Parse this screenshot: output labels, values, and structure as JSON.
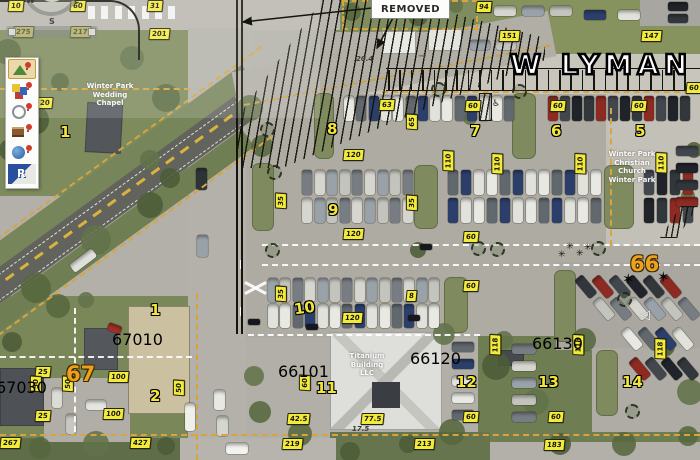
{
  "overlay": {
    "street_name": "W LYMAN",
    "removed_note": "REMOVED",
    "compass": {
      "w": "W",
      "e": "E",
      "s": "S"
    },
    "colors": {
      "label_yellow": "#f3eb3c",
      "lot_number_yellow": "#f2e637",
      "zone_orange": "#efa11c",
      "parcel_red": "#cf3b31",
      "parcel_tan_dash": "#d7a43e",
      "hatch_black": "#15150d"
    },
    "notes": [
      {
        "t": "20.4",
        "x": 356,
        "y": 55
      },
      {
        "t": "17.5",
        "x": 352,
        "y": 425
      }
    ],
    "labels": [
      {
        "t": "10",
        "x": 8,
        "y": 0
      },
      {
        "t": "60",
        "x": 70,
        "y": 0
      },
      {
        "t": "275",
        "x": 13,
        "y": 26
      },
      {
        "t": "217",
        "x": 70,
        "y": 26
      },
      {
        "t": "31",
        "x": 147,
        "y": 0
      },
      {
        "t": "201",
        "x": 149,
        "y": 28
      },
      {
        "t": "94",
        "x": 476,
        "y": 1
      },
      {
        "t": "151",
        "x": 499,
        "y": 30
      },
      {
        "t": "147",
        "x": 641,
        "y": 30
      },
      {
        "t": "60",
        "x": 686,
        "y": 82
      },
      {
        "t": "63",
        "x": 379,
        "y": 99
      },
      {
        "t": "60",
        "x": 465,
        "y": 100
      },
      {
        "t": "60",
        "x": 550,
        "y": 100
      },
      {
        "t": "60",
        "x": 631,
        "y": 100
      },
      {
        "t": "20",
        "x": 37,
        "y": 97
      },
      {
        "t": "120",
        "x": 343,
        "y": 149
      },
      {
        "t": "120",
        "x": 343,
        "y": 228
      },
      {
        "t": "120",
        "x": 342,
        "y": 312
      },
      {
        "t": "60",
        "x": 463,
        "y": 231
      },
      {
        "t": "60",
        "x": 463,
        "y": 280
      },
      {
        "t": "8",
        "x": 406,
        "y": 290
      },
      {
        "t": "60",
        "x": 463,
        "y": 411
      },
      {
        "t": "60",
        "x": 548,
        "y": 411
      },
      {
        "t": "25",
        "x": 35,
        "y": 366
      },
      {
        "t": "25",
        "x": 35,
        "y": 410
      },
      {
        "t": "100",
        "x": 108,
        "y": 371
      },
      {
        "t": "100",
        "x": 103,
        "y": 408
      },
      {
        "t": "42.5",
        "x": 287,
        "y": 413
      },
      {
        "t": "77.5",
        "x": 361,
        "y": 413
      },
      {
        "t": "219",
        "x": 282,
        "y": 438
      },
      {
        "t": "213",
        "x": 414,
        "y": 438
      },
      {
        "t": "183",
        "x": 544,
        "y": 439
      },
      {
        "t": "267",
        "x": 0,
        "y": 437
      },
      {
        "t": "427",
        "x": 130,
        "y": 437
      },
      {
        "t": "110",
        "x": 438,
        "y": 155,
        "k": "v"
      },
      {
        "t": "110",
        "x": 487,
        "y": 158,
        "k": "v"
      },
      {
        "t": "110",
        "x": 570,
        "y": 158,
        "k": "v"
      },
      {
        "t": "110",
        "x": 651,
        "y": 157,
        "k": "v"
      },
      {
        "t": "118",
        "x": 485,
        "y": 339,
        "k": "v"
      },
      {
        "t": "118",
        "x": 568,
        "y": 339,
        "k": "v"
      },
      {
        "t": "118",
        "x": 650,
        "y": 343,
        "k": "v"
      },
      {
        "t": "65",
        "x": 404,
        "y": 116,
        "k": "v"
      },
      {
        "t": "35",
        "x": 273,
        "y": 195,
        "k": "v"
      },
      {
        "t": "35",
        "x": 404,
        "y": 197,
        "k": "v"
      },
      {
        "t": "35",
        "x": 273,
        "y": 288,
        "k": "v"
      },
      {
        "t": "50",
        "x": 28,
        "y": 378,
        "k": "v"
      },
      {
        "t": "50",
        "x": 60,
        "y": 378,
        "k": "v"
      },
      {
        "t": "50",
        "x": 171,
        "y": 382,
        "k": "v"
      },
      {
        "t": "60",
        "x": 297,
        "y": 377,
        "k": "v"
      },
      {
        "t": "8",
        "x": 327,
        "y": 122,
        "k": "n"
      },
      {
        "t": "7",
        "x": 470,
        "y": 124,
        "k": "n"
      },
      {
        "t": "6",
        "x": 551,
        "y": 124,
        "k": "n"
      },
      {
        "t": "5",
        "x": 635,
        "y": 124,
        "k": "n"
      },
      {
        "t": "9",
        "x": 328,
        "y": 203,
        "k": "n"
      },
      {
        "t": "10",
        "x": 294,
        "y": 301,
        "k": "n",
        "r": -8
      },
      {
        "t": "11",
        "x": 316,
        "y": 381,
        "k": "n"
      },
      {
        "t": "12",
        "x": 456,
        "y": 375,
        "k": "n"
      },
      {
        "t": "13",
        "x": 538,
        "y": 375,
        "k": "n"
      },
      {
        "t": "14",
        "x": 622,
        "y": 375,
        "k": "n"
      },
      {
        "t": "1",
        "x": 60,
        "y": 125,
        "k": "n"
      },
      {
        "t": "1",
        "x": 150,
        "y": 303,
        "k": "n"
      },
      {
        "t": "2",
        "x": 150,
        "y": 389,
        "k": "n"
      },
      {
        "t": "67",
        "x": 66,
        "y": 364,
        "k": "z"
      },
      {
        "t": "66",
        "x": 630,
        "y": 254,
        "k": "z"
      },
      {
        "t": "67030",
        "x": -4,
        "y": 378,
        "k": "r"
      },
      {
        "t": "67010",
        "x": 112,
        "y": 330,
        "k": "r"
      },
      {
        "t": "66101",
        "x": 278,
        "y": 362,
        "k": "r"
      },
      {
        "t": "66120",
        "x": 410,
        "y": 349,
        "k": "r"
      },
      {
        "t": "66130",
        "x": 532,
        "y": 334,
        "k": "r"
      }
    ],
    "place_texts": [
      {
        "x": 80,
        "y": 82,
        "w": 60,
        "lines": [
          "Winter Park",
          "Wedding",
          "Chapel"
        ]
      },
      {
        "x": 600,
        "y": 150,
        "w": 64,
        "lines": [
          "Winter Park",
          "Christian",
          "Church",
          "Winter Park"
        ]
      },
      {
        "x": 332,
        "y": 352,
        "w": 70,
        "lines": [
          "Titanium",
          "Building",
          "LLC"
        ]
      }
    ],
    "symbols": [
      {
        "name": "tree-icon",
        "x": 267,
        "y": 165
      },
      {
        "name": "tree-icon",
        "x": 265,
        "y": 243
      },
      {
        "name": "tree-icon",
        "x": 431,
        "y": 82
      },
      {
        "name": "tree-icon",
        "x": 471,
        "y": 241
      },
      {
        "name": "tree-icon",
        "x": 490,
        "y": 242
      },
      {
        "name": "tree-icon",
        "x": 591,
        "y": 241
      },
      {
        "name": "tree-icon",
        "x": 617,
        "y": 292
      },
      {
        "name": "tree-icon",
        "x": 625,
        "y": 404
      },
      {
        "name": "tree-icon",
        "x": 512,
        "y": 84
      },
      {
        "name": "tree-icon",
        "x": 260,
        "y": 122
      },
      {
        "name": "palm-icon",
        "x": 622,
        "y": 272
      },
      {
        "name": "palm-icon",
        "x": 657,
        "y": 270
      },
      {
        "name": "asterisk-icon",
        "x": 566,
        "y": 243
      },
      {
        "name": "asterisk-icon",
        "x": 576,
        "y": 250
      },
      {
        "name": "asterisk-icon",
        "x": 558,
        "y": 251
      },
      {
        "name": "asterisk-icon",
        "x": 584,
        "y": 244
      },
      {
        "name": "car-icon",
        "x": 420,
        "y": 244
      },
      {
        "name": "car-icon",
        "x": 248,
        "y": 319
      },
      {
        "name": "car-icon",
        "x": 306,
        "y": 324
      },
      {
        "name": "car-icon",
        "x": 408,
        "y": 315
      },
      {
        "name": "handicap-icon",
        "x": 492,
        "y": 100
      },
      {
        "name": "left-arrow-icon",
        "x": 640,
        "y": 309
      },
      {
        "name": "east-arrow-icon",
        "x": 418,
        "y": 52
      }
    ]
  },
  "toolbar": {
    "items": [
      {
        "name": "map-pin-tool-icon",
        "selected": true
      },
      {
        "name": "layers-tool-icon",
        "selected": false
      },
      {
        "name": "network-pin-tool-icon",
        "selected": false
      },
      {
        "name": "catalog-pin-tool-icon",
        "selected": false
      },
      {
        "name": "globe-pin-tool-icon",
        "selected": false
      },
      {
        "name": "arcreader-logo-icon",
        "selected": false
      }
    ]
  }
}
